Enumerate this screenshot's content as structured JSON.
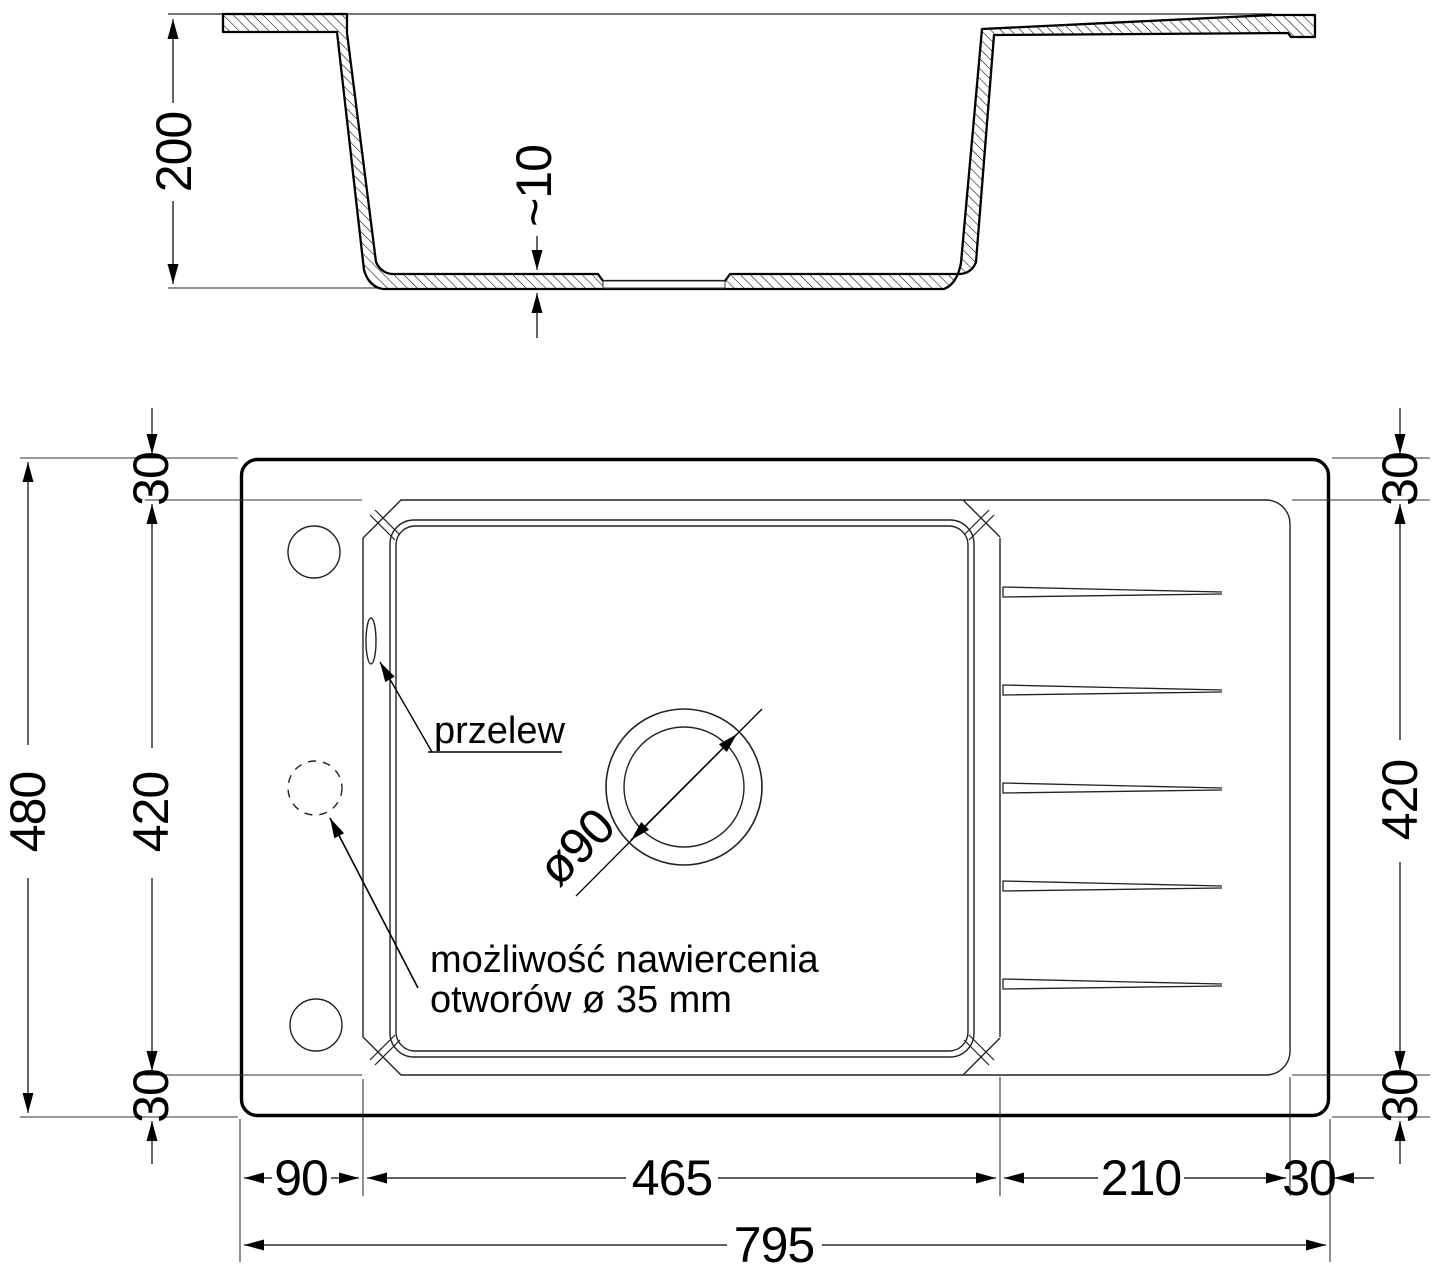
{
  "section_dims": {
    "depth": "200",
    "bottom_thickness": "~10"
  },
  "plan_dims": {
    "overall_length": "795",
    "overall_depth": "480",
    "left_margin_top": "30",
    "left_inner_depth": "420",
    "left_margin_bottom": "30",
    "right_margin_top": "30",
    "right_inner_depth": "420",
    "right_margin_bottom": "30",
    "bottom_left_offset": "90",
    "bottom_bowl_length": "465",
    "bottom_drainer_length": "210",
    "bottom_right_margin": "30"
  },
  "annotations": {
    "overflow_label": "przelew",
    "drill_note_line1": "możliwość nawiercenia",
    "drill_note_line2": "otworów ø 35 mm",
    "drain_diameter_label": "ø90"
  },
  "colors": {
    "line": "#000000",
    "thin_line": "#2b2b2b",
    "background": "#ffffff"
  }
}
